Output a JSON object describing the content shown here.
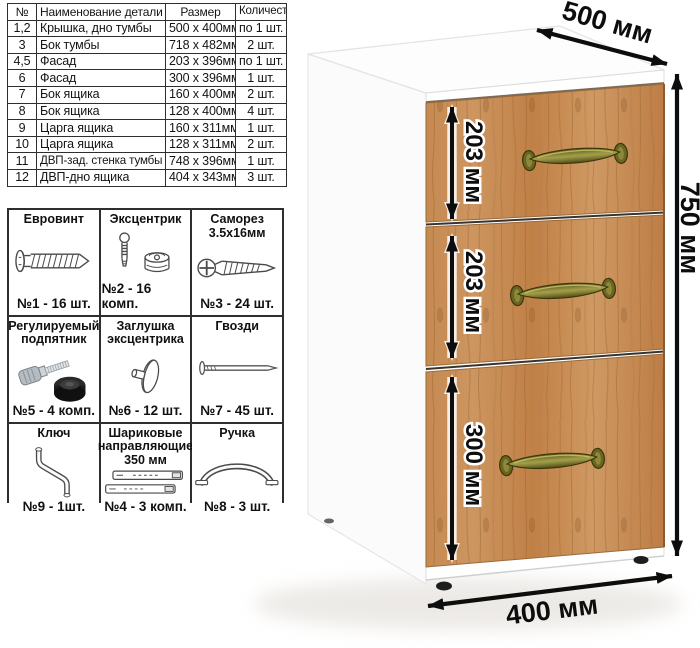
{
  "parts_table": {
    "headers": [
      "№",
      "Наименование детали",
      "Размер",
      "Количество"
    ],
    "rows": [
      {
        "num": "1,2",
        "name": "Крышка, дно тумбы",
        "size": "500 x 400мм",
        "qty": "по 1 шт."
      },
      {
        "num": "3",
        "name": "Бок тумбы",
        "size": "718 x 482мм",
        "qty": "2 шт."
      },
      {
        "num": "4,5",
        "name": "Фасад",
        "size": "203 x 396мм",
        "qty": "по 1 шт."
      },
      {
        "num": "6",
        "name": "Фасад",
        "size": "300 x 396мм",
        "qty": "1 шт."
      },
      {
        "num": "7",
        "name": "Бок ящика",
        "size": "160 x 400мм",
        "qty": "2 шт."
      },
      {
        "num": "8",
        "name": "Бок ящика",
        "size": "128 x 400мм",
        "qty": "4 шт."
      },
      {
        "num": "9",
        "name": "Царга ящика",
        "size": "160 x 311мм",
        "qty": "1 шт."
      },
      {
        "num": "10",
        "name": "Царга ящика",
        "size": "128 x 311мм",
        "qty": "2 шт."
      },
      {
        "num": "11",
        "name": "ДВП-зад. стенка тумбы",
        "size": "748 x 396мм",
        "qty": "1 шт."
      },
      {
        "num": "12",
        "name": "ДВП-дно ящика",
        "size": "404 x 343мм",
        "qty": "3 шт."
      }
    ]
  },
  "hardware_table": {
    "items": [
      {
        "label": "Евровинт",
        "count": "№1 - 16 шт.",
        "icon": "euro-screw-icon"
      },
      {
        "label": "Эксцентрик",
        "count": "№2 - 16 комп.",
        "icon": "cam-lock-icon"
      },
      {
        "label": "Саморез\n3.5x16мм",
        "count": "№3 - 24 шт.",
        "icon": "self-tapping-screw-icon"
      },
      {
        "label": "Регулируемый\nподпятник",
        "count": "№5 - 4 комп.",
        "icon": "adjustable-foot-icon"
      },
      {
        "label": "Заглушка\nэксцентрика",
        "count": "№6 - 12 шт.",
        "icon": "cam-cover-icon"
      },
      {
        "label": "Гвозди",
        "count": "№7 - 45 шт.",
        "icon": "nail-icon"
      },
      {
        "label": "Ключ",
        "count": "№9 - 1шт.",
        "icon": "hex-key-icon"
      },
      {
        "label": "Шариковые\nнаправляющие\n350 мм",
        "count": "№4 - 3 комп.",
        "icon": "ball-bearing-slides-icon"
      },
      {
        "label": "Ручка",
        "count": "№8 - 3 шт.",
        "icon": "handle-icon"
      }
    ]
  },
  "dimensions": {
    "depth_label": "500 мм",
    "height_label": "750 мм",
    "width_label": "400 мм",
    "drawer_labels": [
      "203 мм",
      "203 мм",
      "300 мм"
    ]
  },
  "colors": {
    "wood": "#c68a52",
    "wood_dark": "#8a5a2c",
    "handle_bronze": "#6b661f",
    "dimension_text": "#0d0d0d",
    "table_border": "#2e2e2e"
  }
}
